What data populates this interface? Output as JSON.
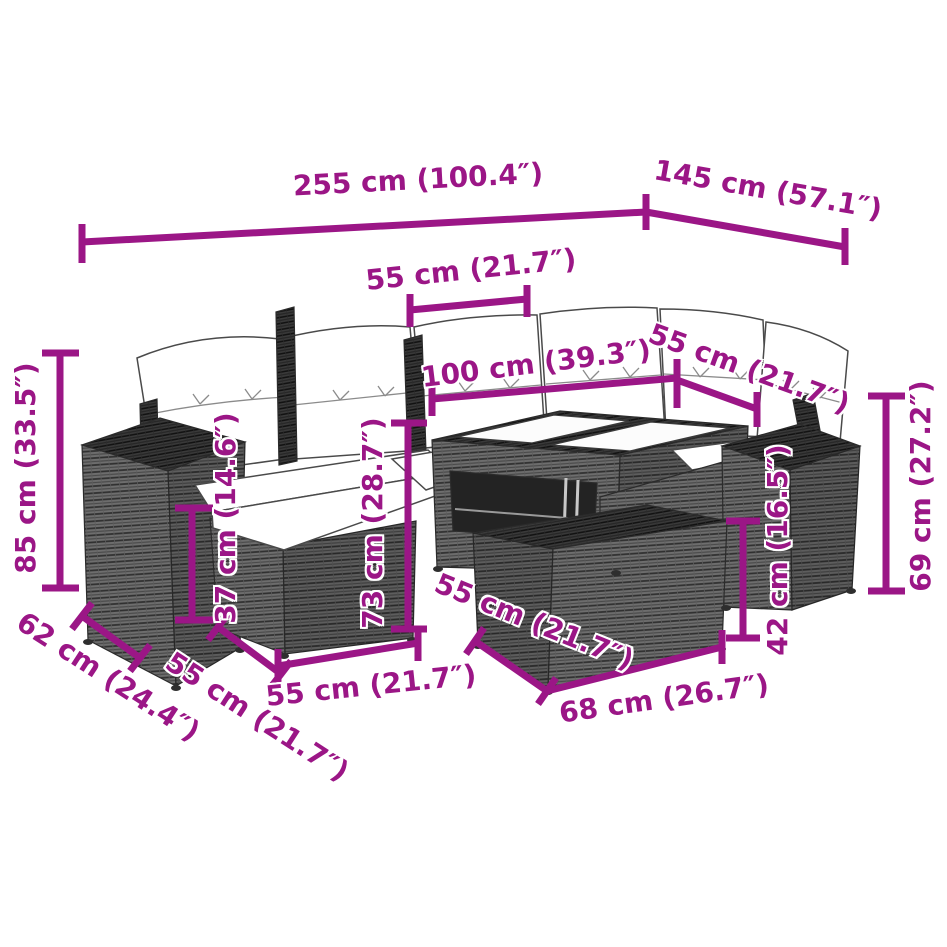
{
  "diagram": {
    "subject": "rattan garden lounge set dimension diagram",
    "accent_color": "#9B1686",
    "background_color": "#FFFFFF",
    "labels": {
      "total_width": "255 cm (100.4″)",
      "total_depth": "145 cm (57.1″)",
      "seat_width_top": "55 cm (21.7″)",
      "sofa_back_length": "100 cm (39.3″)",
      "corner_seat_width": "55 cm (21.7″)",
      "back_height": "85 cm (33.5″)",
      "seat_height": "37 cm (14.6″)",
      "table_height": "73 cm (28.7″)",
      "armrest_height": "69 cm (27.2″)",
      "ottoman_height": "42 cm (16.5″)",
      "armrest_depth": "62 cm (24.4″)",
      "seat_depth": "55 cm (21.7″)",
      "seat_width_front": "55 cm (21.7″)",
      "ottoman_width": "55 cm (21.7″)",
      "ottoman_depth": "68 cm (26.7″)"
    }
  }
}
